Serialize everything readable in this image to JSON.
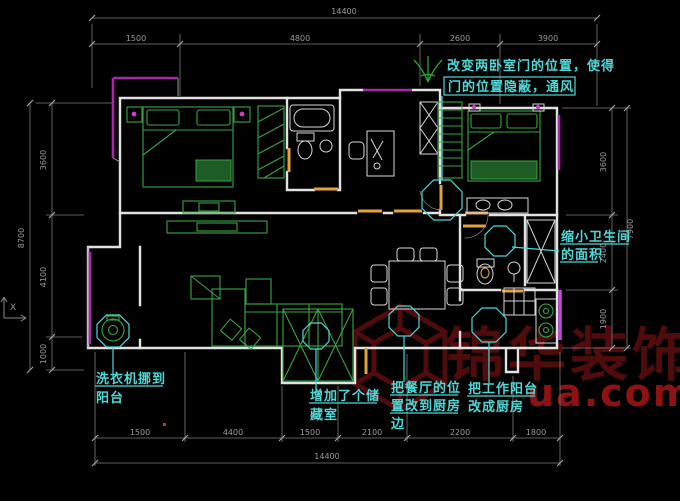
{
  "drawing": {
    "type": "floor-plan-cad-view",
    "background": "#000000"
  },
  "annotations": {
    "doors": {
      "lines": [
        "改变两卧室门的位置，使得",
        "门的位置隐蔽，通风"
      ]
    },
    "bathroom": {
      "lines": [
        "缩小卫生间",
        "的面积"
      ]
    },
    "washer": {
      "lines": [
        "洗衣机挪到",
        "阳台"
      ]
    },
    "storage": {
      "lines": [
        "增加了个储",
        "藏室"
      ]
    },
    "dining": {
      "lines": [
        "把餐厅的位",
        "置改到厨房",
        "边"
      ]
    },
    "kitchen": {
      "lines": [
        "把工作阳台",
        "改成厨房"
      ]
    }
  },
  "dimensions": {
    "top": {
      "total": "14400",
      "segments": [
        "1500",
        "4800",
        "2600",
        "3900"
      ]
    },
    "bottom": {
      "total": "14400",
      "segments": [
        "1500",
        "4400",
        "1500",
        "2100",
        "2200",
        "1800"
      ]
    },
    "left": {
      "total": "8700",
      "segments": [
        "3600",
        "4100",
        "1000"
      ]
    },
    "right": {
      "total": "7900",
      "segments": [
        "3600",
        "2400",
        "1900"
      ]
    }
  },
  "watermark": {
    "brand": "锦华装饰",
    "domain": "ua.com"
  },
  "ucs": {
    "axis_label": "X"
  },
  "colors": {
    "background": "#000000",
    "wall": "#e2e2e2",
    "window": "#a928a9",
    "kitchen_window": "#c44ad6",
    "furniture": "#3aa341",
    "fixture": "#d8d8d8",
    "door": "#e2a23c",
    "dimension": "#9a9a9a",
    "annotation": "#4fd6d6",
    "watermark_dark": "#5c0e0e",
    "watermark_red": "#a31515",
    "lamp": "#cc3fcc",
    "plant": "#2fa32f",
    "toilet_accent": "#c9a227"
  }
}
